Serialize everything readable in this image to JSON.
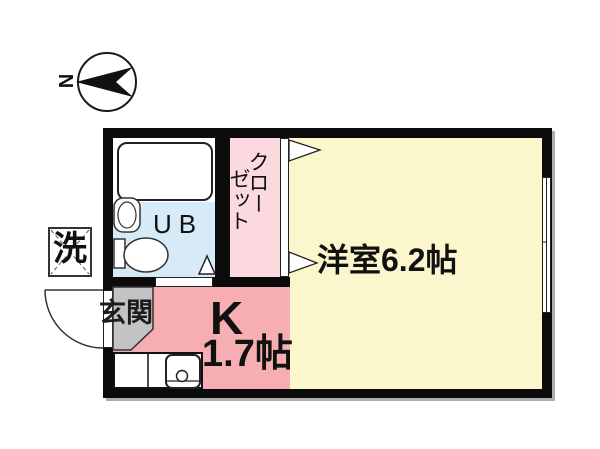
{
  "compass": {
    "north_label": "N"
  },
  "labels": {
    "washer": "洗",
    "unit_bath": "UB",
    "closet_col1": "クロー",
    "closet_col2": "ゼット",
    "entrance": "玄関",
    "main_room": "洋室6.2帖",
    "kitchen": "K",
    "kitchen_size": "1.7帖"
  },
  "rooms": [
    {
      "name": "洋室",
      "size": "6.2帖",
      "type": "western-room"
    },
    {
      "name": "K",
      "size": "1.7帖",
      "type": "kitchen"
    },
    {
      "name": "UB",
      "type": "unit-bath"
    },
    {
      "name": "クローゼット",
      "type": "closet"
    },
    {
      "name": "玄関",
      "type": "entrance"
    }
  ],
  "colors": {
    "main_room": "#FCF6CD",
    "kitchen": "#F7AEB3",
    "closet": "#FBD9DF",
    "bath": "#D6EBF7",
    "entrance": "#C3C3C5",
    "wall": "#0B0B0B"
  }
}
